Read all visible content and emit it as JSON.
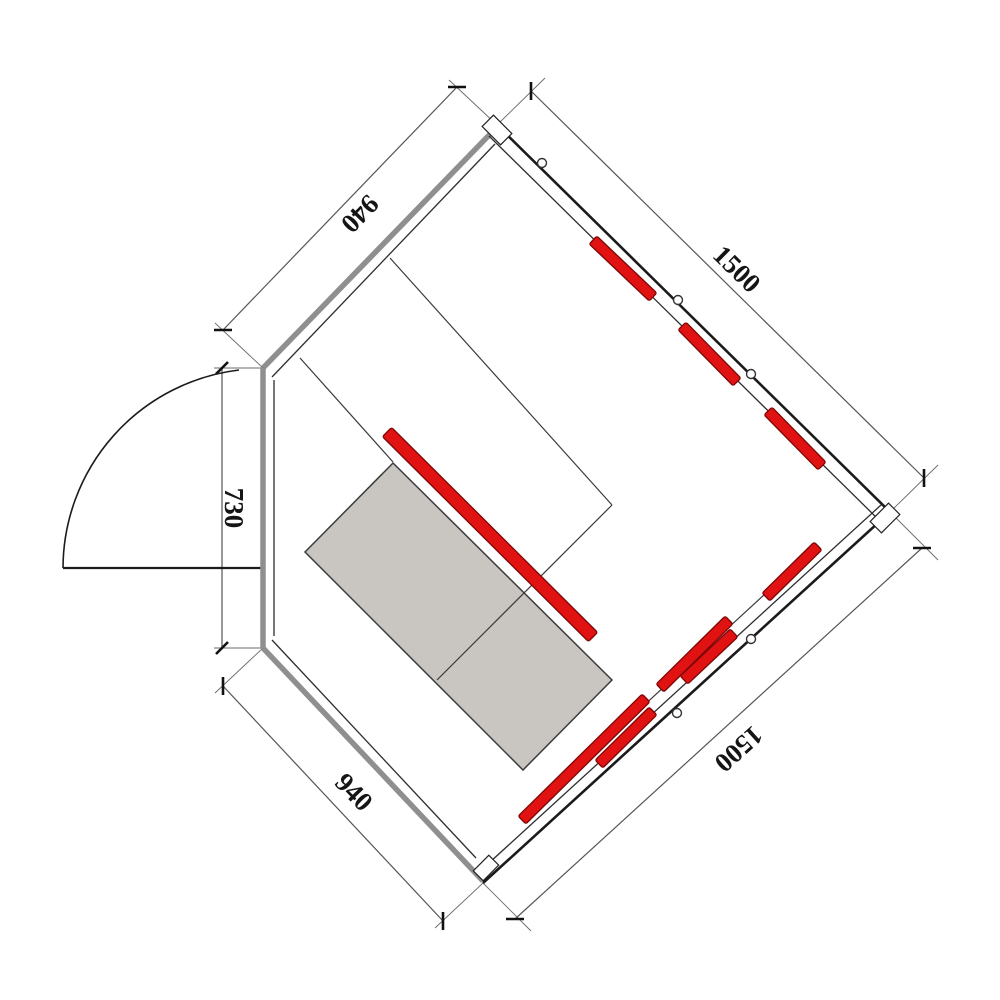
{
  "title": "Corner sauna floor plan drawing",
  "colors": {
    "background": "#ffffff",
    "outer_wall": "#1b1b1b",
    "inner_wall": "#2e2e2e",
    "glass_wall": "#8f8f8f",
    "partition": "#3a3a3a",
    "dim_line": "#555555",
    "ext_line": "#6a6a6a",
    "tick": "#111111",
    "heater_fill": "#e11212",
    "heater_border": "#7d0606",
    "bench_fill": "#c9c5c1",
    "bench_border": "#3c3c3c",
    "vent_fill": "#ffffff",
    "vent_stroke": "#333333",
    "label_color": "#151515"
  },
  "dimensions": [
    {
      "id": "top-left-940",
      "label": "940",
      "x": 358,
      "y": 212,
      "rotate": 134
    },
    {
      "id": "top-right-1500",
      "label": "1500",
      "x": 735,
      "y": 271,
      "rotate": 44.5
    },
    {
      "id": "left-730",
      "label": "730",
      "x": 231,
      "y": 508,
      "rotate": 90
    },
    {
      "id": "bottom-left-940",
      "label": "940",
      "x": 352,
      "y": 794,
      "rotate": 46
    },
    {
      "id": "bottom-right-1500",
      "label": "1500",
      "x": 737,
      "y": 747,
      "rotate": 138
    }
  ],
  "geometry": {
    "glass_walls": [
      {
        "name": "front-glass-wall-top-left",
        "seg": [
          263,
          368,
          497,
          127
        ],
        "w": 5.5
      },
      {
        "name": "front-glass-wall-bottom-left",
        "seg": [
          263,
          648,
          483,
          881
        ],
        "w": 5.5
      },
      {
        "name": "door-wall-left",
        "seg": [
          263,
          368,
          263,
          648
        ],
        "w": 5.5
      }
    ],
    "outer_walls": [
      {
        "name": "back-wall-top-right",
        "seg": [
          497,
          125,
          890,
          512
        ],
        "w": 2.6
      },
      {
        "name": "back-wall-bottom-right",
        "seg": [
          483,
          883,
          890,
          512
        ],
        "w": 2.6
      }
    ],
    "inner_walls": [
      {
        "name": "inner-face-top-left",
        "seg": [
          272,
          377,
          495,
          144
        ],
        "w": 1.3
      },
      {
        "name": "inner-face-top-right",
        "seg": [
          489,
          136,
          880,
          521
        ],
        "w": 1.3
      },
      {
        "name": "inner-face-bottom-right",
        "seg": [
          478,
          873,
          881,
          505
        ],
        "w": 1.3
      },
      {
        "name": "inner-face-bottom-left",
        "seg": [
          272,
          640,
          476,
          858
        ],
        "w": 1.3
      },
      {
        "name": "inner-face-door-wall",
        "seg": [
          274,
          380,
          274,
          636
        ],
        "w": 1.3
      }
    ],
    "partitions": [
      {
        "name": "partition-parallel-back-wall",
        "seg": [
          390,
          258,
          612,
          505
        ],
        "w": 1.2
      },
      {
        "name": "partition-across-bench",
        "seg": [
          612,
          505,
          437,
          680
        ],
        "w": 1.2
      },
      {
        "name": "partition-corner-to-bench",
        "seg": [
          300,
          358,
          393,
          462
        ],
        "w": 1.2
      },
      {
        "name": "heater-rail-bottom-right",
        "seg": [
          528,
          812,
          815,
          548
        ],
        "w": 1.2
      }
    ],
    "dim_lines": [
      {
        "name": "dim-line-940-top-left",
        "seg": [
          223,
          330,
          457,
          87
        ]
      },
      {
        "name": "dim-line-1500-top-right",
        "seg": [
          531,
          91,
          924,
          478
        ]
      },
      {
        "name": "dim-line-730-left",
        "seg": [
          222,
          368,
          222,
          648
        ]
      },
      {
        "name": "dim-line-940-bottom-left",
        "seg": [
          223,
          686,
          443,
          921
        ]
      },
      {
        "name": "dim-line-1500-bottom-right",
        "seg": [
          515,
          919,
          922,
          548
        ]
      }
    ],
    "ext_lines": [
      [
        263,
        368,
        215,
        323
      ],
      [
        497,
        125,
        449,
        80
      ],
      [
        497,
        125,
        545,
        78
      ],
      [
        890,
        512,
        938,
        465
      ],
      [
        263,
        368,
        214,
        368
      ],
      [
        263,
        648,
        214,
        648
      ],
      [
        263,
        648,
        215,
        693
      ],
      [
        483,
        883,
        435,
        928
      ],
      [
        483,
        883,
        531,
        931
      ],
      [
        890,
        512,
        938,
        560
      ]
    ],
    "ticks": [
      [
        214,
        330,
        232,
        330
      ],
      [
        448,
        87,
        466,
        87
      ],
      [
        531,
        82,
        531,
        100
      ],
      [
        924,
        469,
        924,
        487
      ],
      [
        228,
        362,
        216,
        374
      ],
      [
        228,
        642,
        216,
        654
      ],
      [
        223,
        677,
        223,
        695
      ],
      [
        443,
        912,
        443,
        930
      ],
      [
        506,
        919,
        524,
        919
      ],
      [
        913,
        548,
        931,
        548
      ]
    ],
    "bench": {
      "points": "393,463 612,680 523,770 305,552"
    },
    "heaters": [
      {
        "name": "bench-side-heater",
        "seg": [
          387,
          432,
          593,
          637
        ],
        "th": 13
      },
      {
        "name": "wall-heater-top-1",
        "seg": [
          593,
          240,
          653,
          297
        ],
        "th": 11
      },
      {
        "name": "wall-heater-top-2",
        "seg": [
          682,
          326,
          737,
          382
        ],
        "th": 11
      },
      {
        "name": "wall-heater-top-3",
        "seg": [
          768,
          411,
          822,
          466
        ],
        "th": 11
      },
      {
        "name": "wall-heater-bottom-1",
        "seg": [
          522,
          820,
          646,
          698
        ],
        "th": 11
      },
      {
        "name": "wall-heater-bottom-2",
        "seg": [
          599,
          764,
          653,
          711
        ],
        "th": 11
      },
      {
        "name": "wall-heater-bottom-3",
        "seg": [
          660,
          688,
          729,
          620
        ],
        "th": 11
      },
      {
        "name": "wall-heater-bottom-4",
        "seg": [
          684,
          680,
          734,
          633
        ],
        "th": 11
      },
      {
        "name": "wall-heater-right-corner",
        "seg": [
          766,
          597,
          818,
          546
        ],
        "th": 11
      }
    ],
    "vents": [
      {
        "cx": 542,
        "cy": 163
      },
      {
        "cx": 678,
        "cy": 300
      },
      {
        "cx": 751,
        "cy": 374
      },
      {
        "cx": 677,
        "cy": 713
      },
      {
        "cx": 751,
        "cy": 639
      }
    ],
    "corner_caps": [
      {
        "cx": 497,
        "cy": 130,
        "w": 26,
        "h": 16,
        "rot": 45
      },
      {
        "cx": 885,
        "cy": 518,
        "w": 26,
        "h": 16,
        "rot": -45
      },
      {
        "cx": 486,
        "cy": 868,
        "w": 22,
        "h": 14,
        "rot": -45
      }
    ],
    "door": {
      "panel": [
        63,
        568,
        263,
        568
      ],
      "arc": "M 63 568 A 200 200 0 0 1 239 370"
    }
  }
}
